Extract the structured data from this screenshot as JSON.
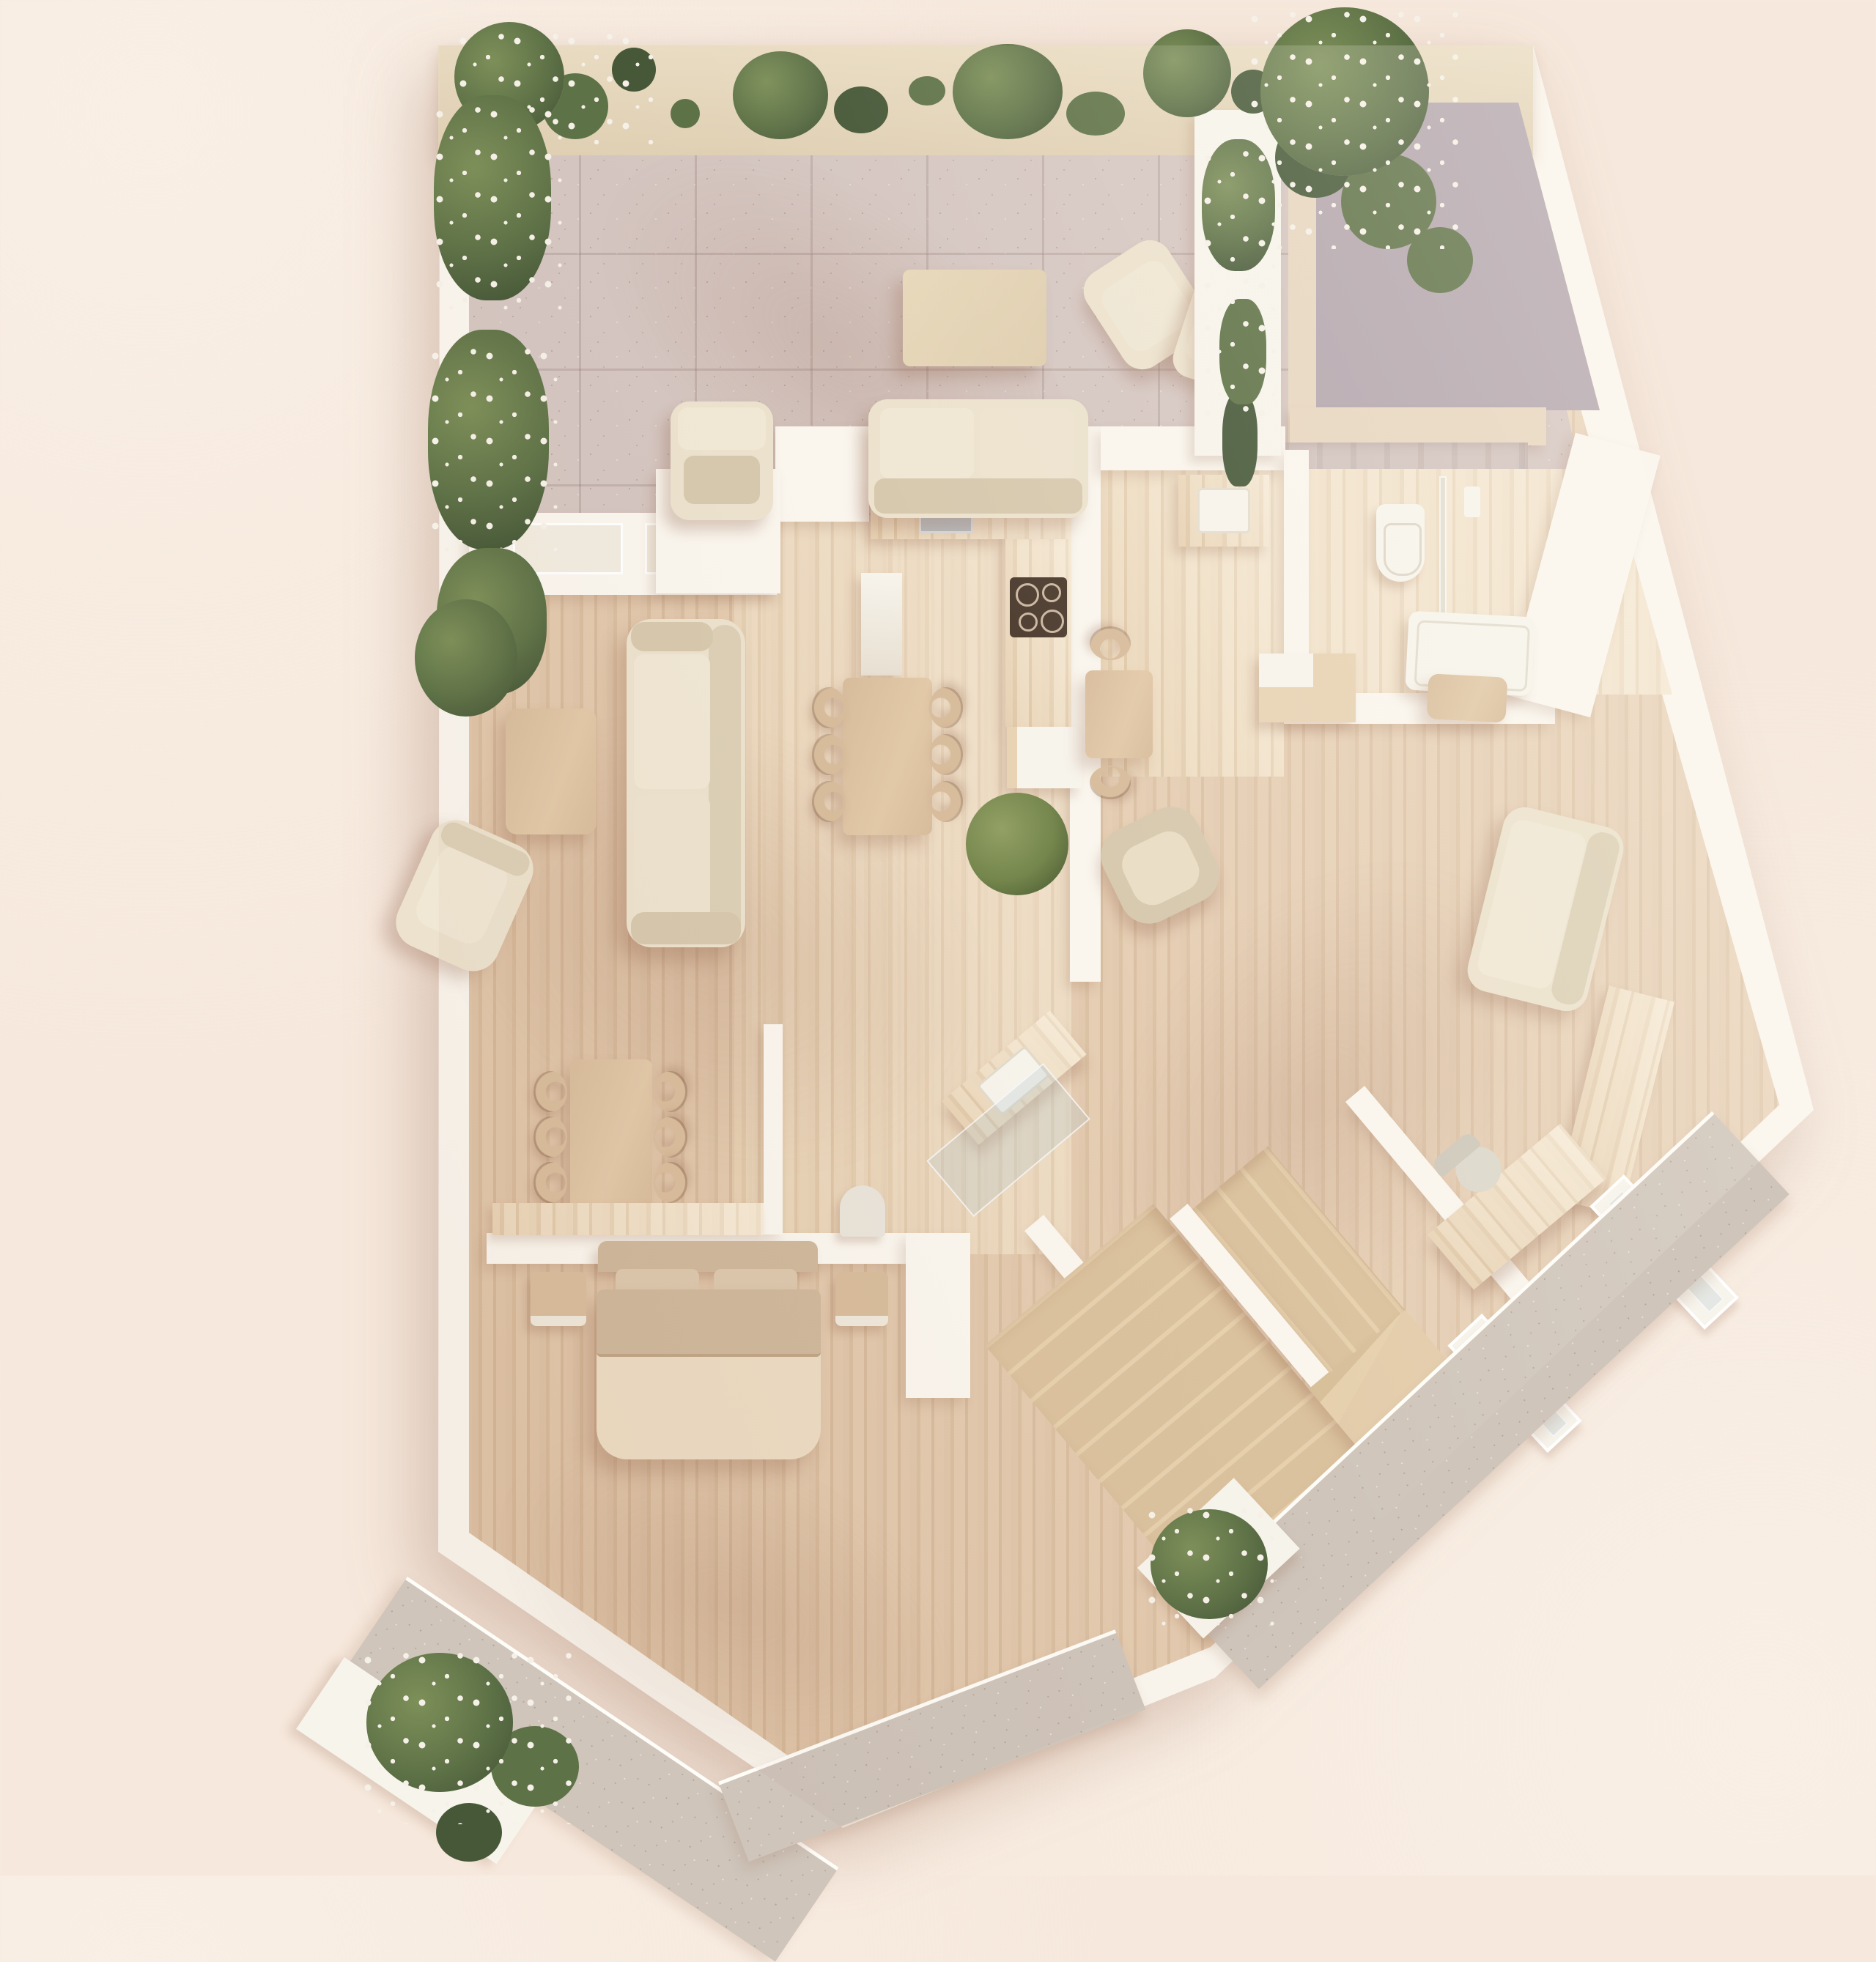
{
  "scene": {
    "kind": "architectural-floor-plan-3d-render",
    "view": "top-down",
    "style": "minimal beige interior visualization, soft sunlight from upper right",
    "text_visible_in_image": "none"
  },
  "palette": {
    "bg": "#f6e8dc",
    "bgEdge": "#f9efe5",
    "wall": "#faf6ee",
    "wallShade": "#eee3d3",
    "pergola": "#e9dcc2",
    "stone": "#d5c6c1",
    "stoneDark": "#c9b9b4",
    "stoneLine": "#b9a7a2",
    "platform": "#b3a6ae",
    "frame": "#e7d6c0",
    "wood": "#dcc1a3",
    "woodDark": "#cfae8d",
    "woodLight": "#e8d3b4",
    "woodPale": "#eedfc6",
    "furnWood": "#d8bd9c",
    "cream": "#ece2cd",
    "creamDark": "#dcd0b6",
    "cushion": "#d7c9ae",
    "white": "#f7f4ec",
    "taupe": "#cfb89c",
    "duvet": "#ecdcc3",
    "cooktop": "#4d3c30",
    "sink": "#b9bec1",
    "platformGray": "#b3a6ae",
    "leafD": "#465838",
    "leafM": "#5e7247",
    "leafL": "#7d9059",
    "flower": "#f6f1e8",
    "gravel": "#cfc5bb"
  },
  "rooms": [
    {
      "id": "terrace",
      "name": "tiled terrace with pergola and planters"
    },
    {
      "id": "living-room",
      "name": "living room"
    },
    {
      "id": "dining-area",
      "name": "dining area"
    },
    {
      "id": "kitchen",
      "name": "kitchen"
    },
    {
      "id": "hallway",
      "name": "entry hall with powder sink"
    },
    {
      "id": "bathroom",
      "name": "bathroom with toilet, shower and bathtub"
    },
    {
      "id": "lounge",
      "name": "second lounge along slanted wall"
    },
    {
      "id": "home-office",
      "name": "home office corner"
    },
    {
      "id": "vanity-hall",
      "name": "inner hall with angled vanity"
    },
    {
      "id": "staircase",
      "name": "winding wooden staircase"
    },
    {
      "id": "bedroom",
      "name": "bedroom"
    },
    {
      "id": "study-nook",
      "name": "study/dining nook with six chairs"
    }
  ],
  "furniture": {
    "terrace": [
      "outdoor table",
      "outdoor sofa",
      "armchair by window bay",
      "rotated armchair",
      "armchair near planter",
      "planter box",
      "raised gray landing",
      "stone entry steps"
    ],
    "living-room": [
      "three-seat sofa",
      "coffee table",
      "swivel armchair",
      "potted plant"
    ],
    "dining-area": [
      "dining table",
      "6 curved chairs",
      "tall white cabinet"
    ],
    "kitchen": [
      "counter with sink",
      "counter with cooktop (4 burners)",
      "island cabinet",
      "plant"
    ],
    "hallway": [
      "wood counter",
      "powder sink"
    ],
    "bathroom": [
      "wall-hung toilet",
      "glass shower screen",
      "flush plate",
      "bathtub",
      "wood step stool"
    ],
    "lounge": [
      "stepped cabinet",
      "small table",
      "2 curved chairs",
      "barrel armchair",
      "sofa along wall",
      "low sideboard"
    ],
    "home-office": [
      "desk",
      "office chair",
      "2 windows in slanted wall"
    ],
    "vanity-hall": [
      "angled vanity counter",
      "vessel sink",
      "glass screen",
      "arched lamp"
    ],
    "bedroom": [
      "double bed",
      "headboard",
      "2 pillows",
      "2 nightstands",
      "console shelf"
    ],
    "study-nook": [
      "long table",
      "6 curved chairs"
    ]
  },
  "plants": [
    "vine garland on pergola (6 clusters)",
    "rose bushes in left wall planter (3)",
    "white flower planter top-right",
    "living room potted bush",
    "kitchen bush",
    "bottom-left flower planter",
    "bottom-right flower planter"
  ],
  "exterior": [
    "gravel path along lower walls",
    "gravel apron at bottom tip"
  ]
}
